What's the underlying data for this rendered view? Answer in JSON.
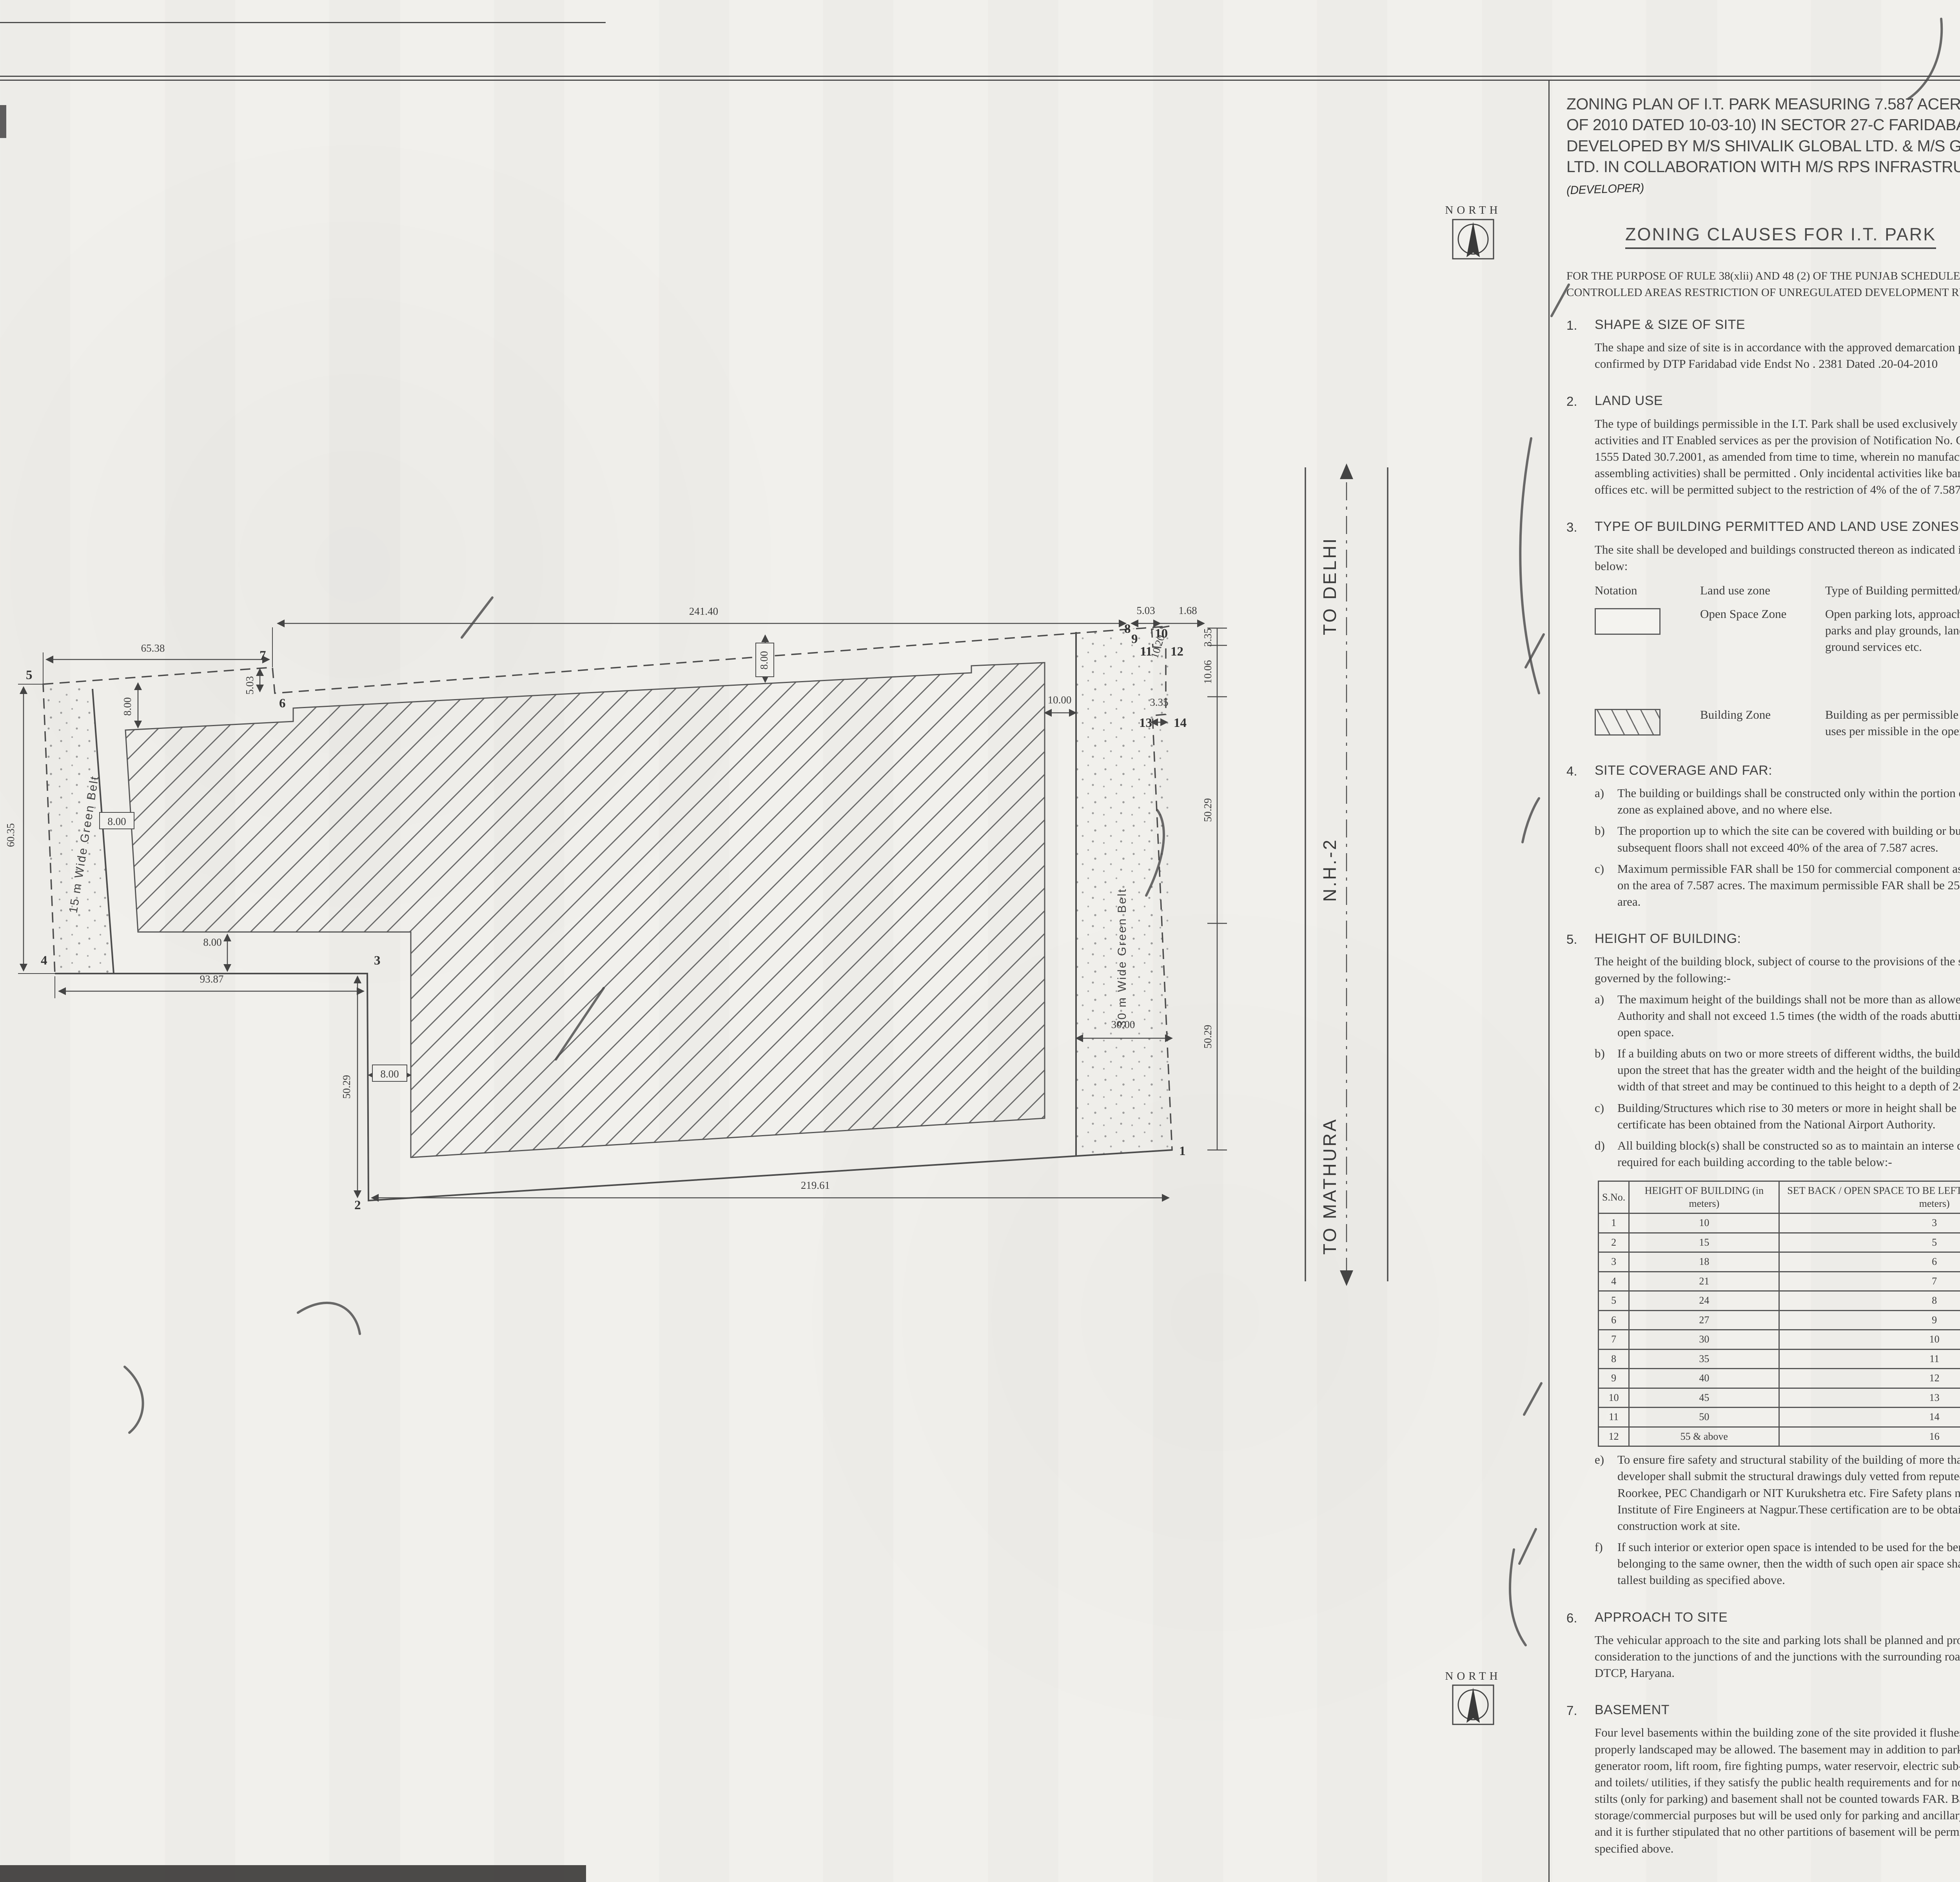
{
  "title_block": {
    "title": "ZONING PLAN OF I.T. PARK MEASURING 7.587 ACERS (LICENCE NO 19 OF 2010 DATED 10-03-10) IN SECTOR 27-C FARIDABAD BEING DEVELOPED BY M/S SHIVALIK GLOBAL LTD. & M/S GANDHAR EXPORTS LTD. IN COLLABORATION WITH M/S RPS INFRASTRUCTURE LTD.",
    "annotation": "(DEVELOPER)"
  },
  "heading": "ZONING CLAUSES FOR I.T. PARK",
  "preamble": "FOR THE PURPOSE OF RULE 38(xlii) AND 48 (2) OF THE PUNJAB SCHEDULED ROADS AND . CONTROLLED AREAS RESTRICTION OF UNREGULATED DEVELOPMENT RULES,1965",
  "clauses": {
    "c1": {
      "no": "1.",
      "title": "SHAPE & SIZE OF SITE",
      "body": "The shape and size of site is in accordance with the approved demarcation plan shown as 1 to14 . as confirmed by DTP Faridabad vide  Endst No . 2381  Dated .20-04-2010"
    },
    "c2": {
      "no": "2.",
      "title": "LAND USE",
      "body": "The type of buildings permissible in the I.T. Park shall be used exclusively for the software development activities and IT Enabled services as per the provision of Notification No. CCP (NCR) / GDP-III / 2001 / 1555 Dated 30.7.2001, as amended from time to time, wherein no manufacturing of any kind (including assembling activities) shall be permitted . Only incidental activities like banks, restaurants, insurance offices etc. will be permitted subject to the restriction of 4% of the of 7.587 acres."
    },
    "c3": {
      "no": "3.",
      "title": "TYPE OF BUILDING PERMITTED AND LAND USE ZONES :",
      "body": "The site shall be developed and buildings constructed thereon as indicated in and explained  in the table below:",
      "table": {
        "h1": "Notation",
        "h2": "Land use zone",
        "h3": "Type of Building permitted/pe rmissible structures.",
        "rows": [
          {
            "zone": "Open Space Zone",
            "desc": "Open parking lots, approach roads, roadside furniture, parks and play grounds, landscaping features, under ground services etc."
          },
          {
            "zone": "Building Zone",
            "desc": "Building as per permissible land use in clause2 above and uses per missible in the open space zone."
          }
        ]
      }
    },
    "c4": {
      "no": "4.",
      "title": "SITE COVERAGE AND FAR:",
      "items": [
        {
          "l": "a)",
          "t": "The building or buildings shall be constructed only within the portion of the site marked  as Building zone as explained above, and no where else."
        },
        {
          "l": "b)",
          "t": "The proportion up to which the site can be covered  with building or buildings on the  ground floor and subsequent floors shall not exceed 40% of the area of 7.587 acres."
        },
        {
          "l": "c)",
          "t": "Maximum permissible FAR shall be 150 for commercial component as explained above in  clause 2 on the area of 7.587 acres. The maximum permissible FAR shall be 250 for IT units in the balance area."
        }
      ]
    },
    "c5": {
      "no": "5.",
      "title": "HEIGHT OF BUILDING:",
      "intro": "The height of the building block, subject of course to the provisions of the site coverage  and FAR, shall be governed by the following:-",
      "items": [
        {
          "l": "a)",
          "t": "The maximum height of the buildings shall not be more than as allowed by National Airport Authority and shall not  exceed 1.5 times (the width of the roads abutting to the site) plus  the front open space."
        },
        {
          "l": "b)",
          "t": "If a building abuts on two or more streets of different widths, the buildings shall be  deemed to face upon the street that has the greater width and the height of the buildings  shall be regulated by the width of that street and may be continued to this height to a   depth of 24M, along the narrow street."
        },
        {
          "l": "c)",
          "t": "Building/Structures which rise to 30 meters or more in height shall be constructed if no objection certificate has been obtained from the National Airport Authority."
        },
        {
          "l": "d)",
          "t": "All building block(s) shall be constructed so as to maintain an interse distance not less the set back required for each building according to the table below:-"
        }
      ],
      "table": {
        "h1": "S.No.",
        "h2": "HEIGHT OF BUILDING (in meters)",
        "h3": "SET BACK / OPEN SPACE TO BE LEFT AROUND BUILDINGS. (in meters)",
        "rows": [
          [
            "1",
            "10",
            "3"
          ],
          [
            "2",
            "15",
            "5"
          ],
          [
            "3",
            "18",
            "6"
          ],
          [
            "4",
            "21",
            "7"
          ],
          [
            "5",
            "24",
            "8"
          ],
          [
            "6",
            "27",
            "9"
          ],
          [
            "7",
            "30",
            "10"
          ],
          [
            "8",
            "35",
            "11"
          ],
          [
            "9",
            "40",
            "12"
          ],
          [
            "10",
            "45",
            "13"
          ],
          [
            "11",
            "50",
            "14"
          ],
          [
            "12",
            "55 & above",
            "16"
          ]
        ]
      },
      "items2": [
        {
          "l": "e)",
          "t": "To ensure fire safety and structural stability of the building of more than 60 meters in height,   the developer shall submit the structural drawings duly vetted from reputed institute like-  IIT Delhi, IIT Roorkee, PEC Chandigarh or NIT Kurukshetra etc. Fire Safety plans needs to be  vetted by the Institute of Fire Engineers at Nagpur.These certification are to be obtained prior  to starting the construction work at site."
        },
        {
          "l": "f)",
          "t": "If such interior or exterior open space is intended to be used for the benefit of more  than  one building belonging to the same owner, then the width of such open air space  shall be the  one specified for the tallest building as specified above."
        }
      ]
    },
    "c6": {
      "no": "6.",
      "title": "APPROACH TO SITE",
      "body": "The vehicular approach to the site and parking lots shall be planned and provided giving due consideration to the junctions of and the junctions with the surrounding roads to the  satisfaction of the DTCP, Haryana."
    },
    "c7": {
      "no": "7.",
      "title": "BASEMENT",
      "body": "Four level basements within the building zone of the site provided it flushes with the  ground and is properly landscaped may be allowed. The basement may in addition to  parking could be utilized for generator room, lift room, fire fighting pumps, water  reservoir, electric sub-station, air conditioning plants and toilets/ utilities, if they satisfy the  public health requirements and for no other purposes. Area under stilts (only for parking) and basement shall not be counted towards FAR.   Basement shall not be used for  storage/commercial purposes but will be used only for parking and ancillary services of the main building and  it is further stipulated that no other partitions of basement will be permissible for uses other than those specified above."
    },
    "c8": {
      "no": "8.",
      "title": "PARKING",
      "items": [
        {
          "l": "a.",
          "t": "Adequate parking spaces i.e. covered, open or in the basement shall be provided for the vehicles."
        },
        {
          "l": "b.",
          "t": "The four level basements are permissible for parking and for provision of services like AHU. Parking shall be made available at ground level also."
        },
        {
          "l": "c.",
          "t": "The parking spaces shall not be less than 1 PCU for 40 sq.m. of covered area on all floors."
        },
        {
          "l": "d.",
          "t": "Minimum 10% of the car parking space shall be made available for the visitors having commercial vehicles like Taxis, Buses used for ferrying the employees of the IT companies. This car parking space can be provided in the form of multi - storeyed building along with a facility like canteen, toilet and rest room for the drivers subject to the limit of maximum 75 sqm, within the zoned area. The parking structure shall also be planned in such a manner that it will maintain the intense distance from the main building and the building of adjoining properties. The above facility shall be free of user charge."
        },
        {
          "l": "e.",
          "t": "Minimum 5% parking space shall be provided for casual visitor at the ground level."
        },
        {
          "l": "f.",
          "t": "The car parking space shall be provided to the allottee/ owners of the IT spaces as per their aetual requirement assessed at the time of sale purchase agreement."
        },
        {
          "l": "g.",
          "t": "The area for aprking per PCU shall be as under:-"
        }
      ],
      "pcu": [
        [
          "Basement",
          "= 35 sq mtr."
        ],
        [
          "Stilts",
          "= 30 sq mtr."
        ],
        [
          "Open",
          "= 25 sq mtr."
        ]
      ],
      "item_h": {
        "l": "h.",
        "t": "The covered parking in the basement or in the form of multi level parking above ground level shall not be counted towards FAR. However, in case of multi level parking above the ground level the foot print of separate parking building block shall be counted towards ground coverage. In case of provision of mechanical parking in the basement floor/ upper stories, the floor to ceiling height of the basement/ upper floor may be maximum of 4.5 mtr. Other than the mechanical parking the floor to ceiling height in upper floor shall not be more than 2.4 mtr. below the hanging beam."
      }
    },
    "c9": {
      "no": "9.",
      "title": "WIDTH/ SLOPE OF RAMP.",
      "body": "The clear width of the ramp leading to the basement floor shall be minimum 4 mtrs. with an adequate slope  not steeper than 1:10. The entry and exit shall be seperete preferably at opposite ends."
    },
    "c10": {
      "no": "10.",
      "title": "PLANNING NORMS;",
      "body": "The building/buildings  to be constructed shall be planned and designed to the norms  and standards as approved by DTCP, Haryana."
    },
    "c11": {
      "no": "11.",
      "title": "PROVISION OF PUBLIC HEALTH FACILITIES",
      "body": "The W.C. and urinals provided in the buildings shall conform to the National Building Code/Act No. 41 of 1963 and rules framed there under."
    },
    "c12": {
      "no": "12.",
      "title": "SUB-DIVISION OF SITE    :",
      "body": "No sub-division of the I.T. Park site shall be permitted."
    },
    "c13": {
      "no": "13.",
      "title": "WIDTH OF COVERED PUBLIC CORRIDOR      :",
      "body": "The width of the corridor would be governed by Rule 82 of the Rules, 1965."
    },
    "c14": {
      "no": "14.",
      "title": "GATE POST AND BOUNDARY WALL .",
      "body": "Such Boundary wall, railings or their combination, hedges or fences along with gates gate posts shall be constructed as per design approved by DTCP Haryana. In addition to the gate/gates an additional wicket gate not exceeding 1.25 mtrs width may be allowed in the front and side boundary wall provided that no main gate or wicket gate shall be allowed to open on to the sector road/ public open space."
    },
    "c15": {
      "no": "15.",
      "title": "EXTERNAL FINISHES",
      "items": [
        {
          "l": "a)",
          "t": "The external wall finishes, so far as possible shall be in natural or permanent type of materials like  bricks, stone, concrete, terracotta, grits, marble,  chips, glass, metals or any other finish which may  be allowed by the DTCP."
        },
        {
          "l": "b)",
          "t": "The water storage tanks and plumbing works shall not be visible on any face of the building and  shall be suitable encased."
        },
        {
          "l": "c)",
          "t": "All sign boards and names shall be written on the spaces pr ovided on buildings as per approved buildings plans specifically for this purpose and at no other places, whatsoever."
        }
      ]
    },
    "c16": {
      "no": "16.",
      "title": "APPROVAL OF BUILDING PLANS",
      "body": "The building plans of the buildings to be constructed at site shall have to be got approved from the DTCP, Haryana (under section 8(2) of the Act No.41 of 1963), before taking up the construction."
    },
    "c17": {
      "no": "17.",
      "title": "BUILDING BYE- LAWS:",
      "body": "The construction of the building/buildings shall be governed by the building rules provided in part Controlled Areas, Restriction of Unregulated Development  VII of the Punjab Scheduled Roads and   1987 regarding provisions for Physically Handicapped Persons.On  Rules, 1965 and IS Code No. 4963- the point where such rules are silent and stipulate no condition or norm, the model building byelaw issued by the ISI, and as given in the NBC shall be followed as may be approved by DTCP, Haryana."
    },
    "c18": {
      "no": "18.",
      "title": "FIRE SAFETY MEASURES:",
      "items": [
        {
          "l": "a)",
          "t": "The owner will ensure the provision of proper fire safety measures in the multi storeyed buildings conforming to the provisions of  Rules 1965/ NBC and the same should be got certified from the competent authority."
        },
        {
          "l": "b)",
          "t": "Electric Sub Station / generator room if provided should be on solid ground near DG/LT. Control periphery of the  panel on ground floor or in upper basement and it should be located on outer building, the same should be got approved from the Chief Electrical inspector Haryana."
        }
      ]
    },
    "c19": {
      "no": "19.",
      "title": "SOLAR WATER HEATING SYSTEM",
      "body": "The provision of solar water heating system shall be as per norms specified by HAREDA  and shall be made operational in each building block if hot water is required before applying for an occupation certificate."
    },
    "c20": {
      "no": "20.",
      "title": "RAIN WATER HARVESTING SYSTEM.",
      "body": "The rain water harvesting system shall be provided as per Central Ground Water Authority norms/Haryana Govt. notification as applicable."
    },
    "c21": {
      "no": "21",
      "body": "The coloniser shall obtain the clearance/NOC as per the provisions of the Notification  No. S.O. 1533 (E) Dated 14.9.2006 issued by Ministry of Environment and Forest,  Government of India before starting the construction/ execution of development  works at site."
    },
    "c22": {
      "no": "22",
      "body": "The coloniser/owner shall use only Compact Fluorescent Lamps fittings for internal lighting as well as campus lighting."
    },
    "c23": {
      "no": "23.",
      "body": "The colonizer shall convey the ultimate power load requirement of your project to the concerned power utility to enable the provision of  site for transformer /switching station /electric sub station as per the norms prescribed by the power utility in your project site at the time of approval of  building plan"
    }
  },
  "drg_line": "DRG. NO. D.T.C.P.----------DATED----------",
  "signatures": [
    {
      "name": "(Sunita Sethi)",
      "title": "DTP(HQ)"
    },
    {
      "name": "(J.S.Redhu)",
      "title": "CTP(HR)"
    },
    {
      "name": "(T.C.Gupta,IAS)",
      "title": "D.T.C.P.(HR)"
    }
  ],
  "plan": {
    "north_label": "NORTH",
    "green_belt_west": "15 m Wide Green Belt",
    "green_belt_east": "30 m Wide Green Belt",
    "road": {
      "to_delhi": "TO DELHI",
      "highway": "N.H.-2",
      "to_mathura": "TO MATHURA"
    },
    "dims": {
      "top_left": "65.38",
      "jog_left": "5.03",
      "top_main": "241.40",
      "top_right_a": "5.03",
      "top_right_b": "1.68",
      "right_a": "3.35",
      "right_b": "10.06",
      "right_c": "10.20",
      "right_d": "50.29",
      "right_e": "50.29",
      "right_f": "3.35",
      "left_side": "60.35",
      "bottom_left": "93.87",
      "bottom_main": "219.61",
      "mid_vert": "50.29",
      "belt_east_width": "30.00",
      "gap_east": "10.00",
      "sb_top": "8.00",
      "sb_west": "8.00",
      "sb_bottom": "8.00",
      "sb_mid": "8.00",
      "sb_topright": "8.00"
    },
    "vertices": {
      "v1": "1",
      "v2": "2",
      "v3": "3",
      "v4": "4",
      "v5": "5",
      "v6": "6",
      "v7": "7",
      "v8": "8",
      "v9": "9",
      "v10": "10",
      "v11": "11",
      "v12": "12",
      "v13": "13",
      "v14": "14"
    }
  }
}
